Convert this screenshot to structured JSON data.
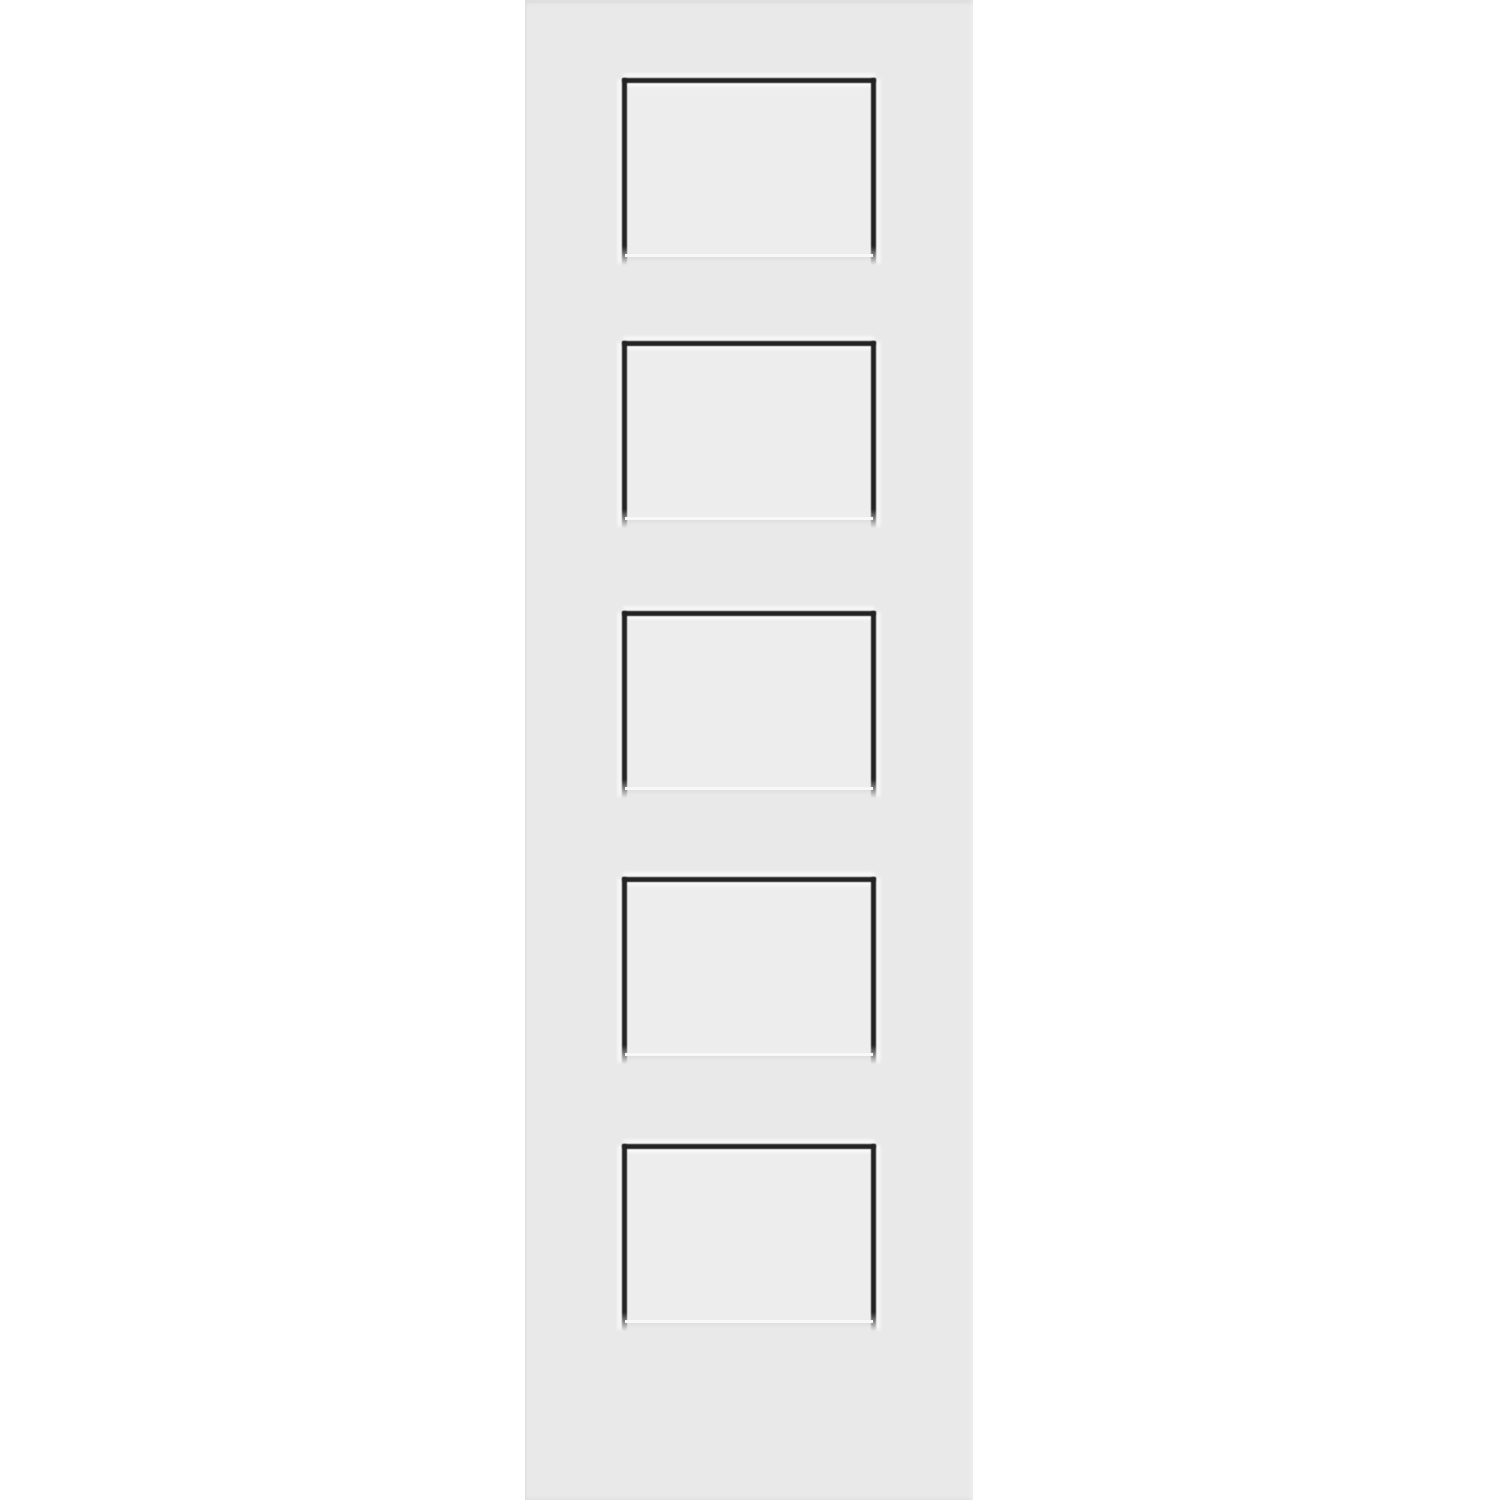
{
  "image": {
    "type": "product-photo",
    "label": "White 5-panel shaker interior door slab on white background"
  },
  "door": {
    "label": "5-panel shaker door slab, white primed",
    "panel_count": 5,
    "panels": [
      {
        "id": "panel-1",
        "label": "recessed panel 1 (top)"
      },
      {
        "id": "panel-2",
        "label": "recessed panel 2"
      },
      {
        "id": "panel-3",
        "label": "recessed panel 3 (middle)"
      },
      {
        "id": "panel-4",
        "label": "recessed panel 4"
      },
      {
        "id": "panel-5",
        "label": "recessed panel 5 (bottom)"
      }
    ]
  },
  "colors": {
    "background": "#ffffff",
    "door_face": "#e9e9e9",
    "panel_field": "#ededed",
    "groove": "#232323",
    "highlight": "#ffffff"
  }
}
